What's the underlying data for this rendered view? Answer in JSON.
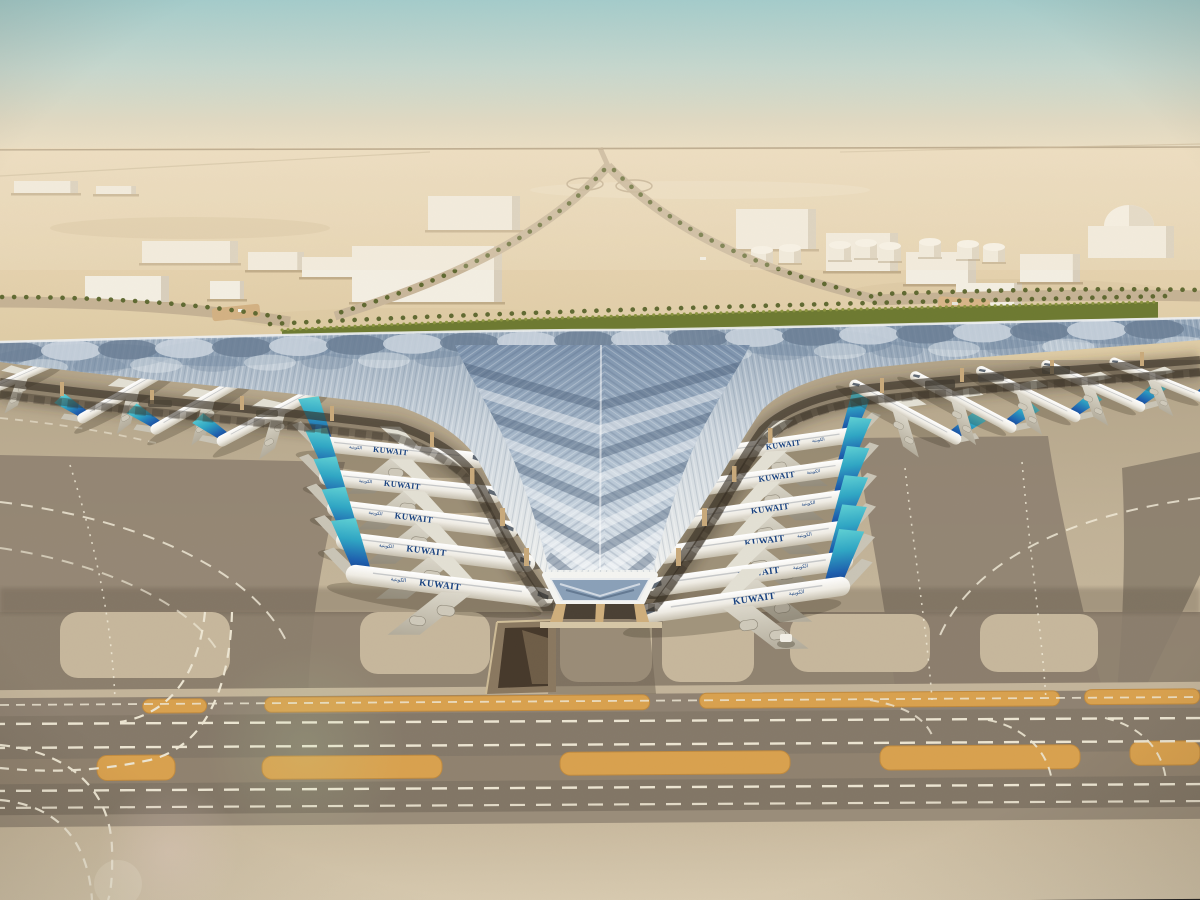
{
  "meta": {
    "title": "Aerial rendering of a desert airport terminal with trefoil canopy roof",
    "environment": "desert",
    "view": "aerial"
  },
  "scene": {
    "airline_label": "KUWAIT",
    "airline_label_ar": "الكويتية",
    "sky": {
      "top_color": "#a4cbca",
      "haze_color": "#e3dac2"
    },
    "terminal": {
      "roof_color": "#eff1f0",
      "glazing_color": "#8ba1ba",
      "glazing_dark": "#5d7390",
      "facade_color": "#c9a472",
      "facade_glow": "#e6c288",
      "gable_glazed": true
    },
    "aircraft": {
      "total_visible": 20,
      "left_pier_count": 5,
      "right_pier_count": 6,
      "left_wing_count": 4,
      "right_wing_count": 5,
      "fuselage_color": "#f3f0e8",
      "tail_teal": "#3fc0c9",
      "tail_blue": "#184f9e",
      "label_color": "#16407f",
      "positions": [
        [
          18,
          378,
          0.48,
          -24,
          1,
          false
        ],
        [
          128,
          392,
          0.55,
          -30,
          1,
          false
        ],
        [
          203,
          402,
          0.57,
          -30,
          1,
          false
        ],
        [
          273,
          414,
          0.6,
          -28,
          1,
          false
        ],
        [
          399,
          452,
          0.84,
          6,
          1,
          true
        ],
        [
          411,
          486,
          0.88,
          6,
          1,
          true
        ],
        [
          423,
          519,
          0.92,
          7,
          1,
          true
        ],
        [
          436,
          552,
          0.96,
          7,
          1,
          true
        ],
        [
          450,
          586,
          1.0,
          7,
          1,
          true
        ],
        [
          775,
          446,
          0.84,
          -8,
          -1,
          true
        ],
        [
          768,
          478,
          0.88,
          -8,
          -1,
          true
        ],
        [
          761,
          510,
          0.92,
          -8,
          -1,
          true
        ],
        [
          755,
          542,
          0.96,
          -8,
          -1,
          true
        ],
        [
          749,
          574,
          1.0,
          -8,
          -1,
          true
        ],
        [
          744,
          600,
          1.02,
          -8,
          -1,
          true
        ],
        [
          905,
          412,
          0.6,
          28,
          -1,
          false
        ],
        [
          963,
          402,
          0.57,
          28,
          -1,
          false
        ],
        [
          1028,
          394,
          0.55,
          26,
          -1,
          false
        ],
        [
          1093,
          386,
          0.54,
          24,
          -1,
          false
        ],
        [
          1158,
          380,
          0.5,
          22,
          -1,
          false
        ]
      ]
    },
    "ground": {
      "apron_color": "#c1b297",
      "taxiway_color": "#857969",
      "marking_orange": "#d9a14e",
      "dash_color": "#ece5d2",
      "parallel_taxiways": 2,
      "dashed_centerlines": true,
      "service_tunnel_ramp": true
    },
    "background": {
      "warehouses": 12,
      "fuel_tanks": 8,
      "domes": 1,
      "hedge_color": "#6d7a31",
      "palm_color": "#5a652c",
      "desert_color": "#e4d1ad",
      "palm_lined_roads": true,
      "highway_interchange": true
    }
  }
}
